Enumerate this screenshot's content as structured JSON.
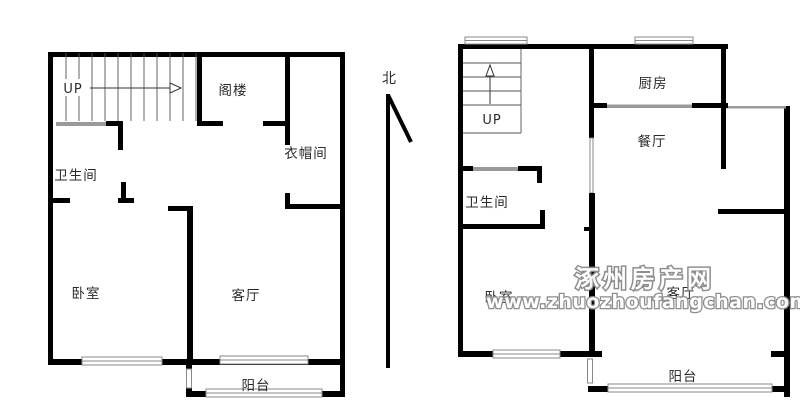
{
  "left_unit": {
    "stairs": "UP",
    "attic": "阁楼",
    "cloakroom": "衣帽间",
    "bathroom": "卫生间",
    "bedroom": "卧室",
    "living_room": "客厅",
    "balcony": "阳台"
  },
  "right_unit": {
    "stairs": "UP",
    "kitchen": "厨房",
    "dining_room": "餐厅",
    "bathroom": "卫生间",
    "bedroom": "卧室",
    "living_room": "客厅",
    "balcony": "阳台"
  },
  "compass": {
    "north": "北"
  },
  "watermark": {
    "site_name": "涿州房产网",
    "site_url": "www.zhuozhoufangchan.com",
    "color": "#8a8a8a"
  },
  "colors": {
    "wall": "#000000",
    "door": "#9a9a9a",
    "background": "#ffffff",
    "label": "#2b2b2b"
  }
}
